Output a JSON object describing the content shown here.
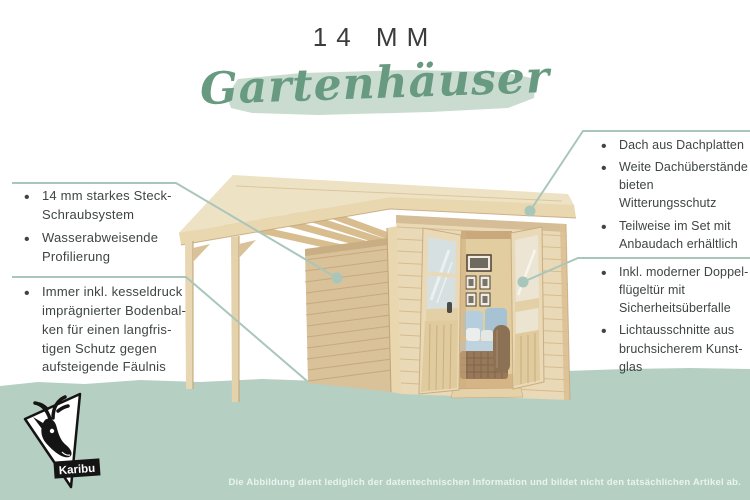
{
  "title": {
    "line1": "14 MM",
    "script": "Gartenhäuser"
  },
  "left_callouts": [
    {
      "items": [
        "14 mm starkes Steck-Schraubsystem",
        "Wasserabweisende Profilierung"
      ]
    },
    {
      "items": [
        "Immer inkl. kesseldruck imprägnierter Boden­bal­ken für einen lang­fris­tigen Schutz gegen aufsteigende Fäulnis"
      ]
    }
  ],
  "right_callouts": [
    {
      "items": [
        "Dach aus Dachplatten",
        "Weite Dachüberstände bieten Witterungsschutz",
        "Teilweise im Set mit Anbaudach erhältlich"
      ]
    },
    {
      "items": [
        "Inkl. moderner Doppel­flügeltür mit Sicherheits­überfalle",
        "Lichtausschnitte aus bruchsicherem Kunst­glas"
      ]
    }
  ],
  "logo": {
    "brand": "Karibu"
  },
  "footer": {
    "disclaimer": "Die Abbildung dient lediglich der datentechnischen Information und bildet nicht den tatsächlichen Artikel ab."
  },
  "colors": {
    "accent_green": "#679a80",
    "mint_light": "#c9dccf",
    "sage_ground": "#b6cfc3",
    "callout_line": "#a9c6ba",
    "text_dark": "#3f4445",
    "wood_light": "#ead9b6",
    "wood_mid": "#d9c199",
    "roof_top": "#eee2c4",
    "interior_wall": "#e2cda0",
    "sofa_blue": "#b4cedd",
    "wicker": "#97795a",
    "disclaimer_text": "#e9f4ee"
  }
}
